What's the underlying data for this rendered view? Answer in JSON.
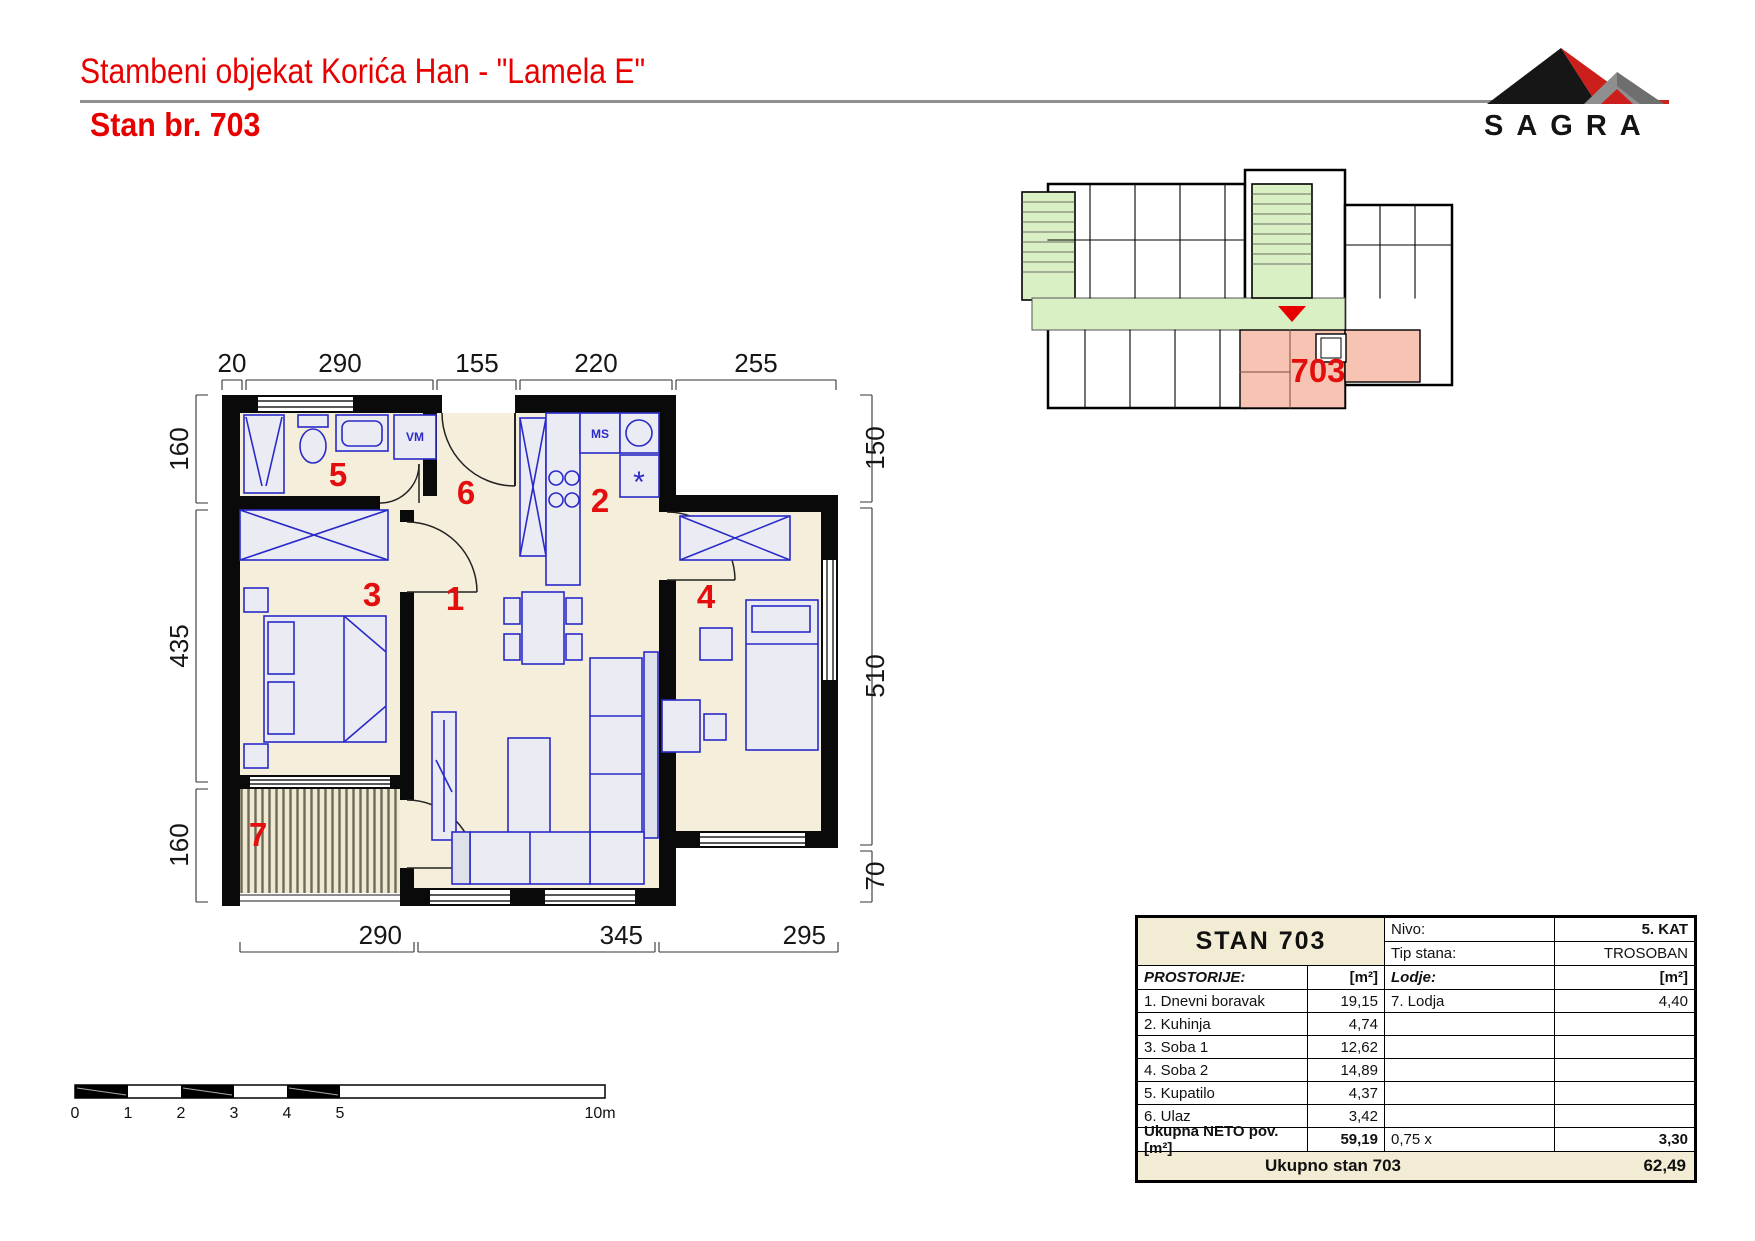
{
  "header": {
    "project_title": "Stambeni objekat Korića Han - \"Lamela E\"",
    "apartment_title": "Stan br. 703",
    "logo_text": "SAGRA"
  },
  "floor_plan": {
    "room_numbers": [
      "1",
      "2",
      "3",
      "4",
      "5",
      "6",
      "7"
    ],
    "fixture_labels": {
      "washing_machine": "VM",
      "kitchen_cabinet": "MS",
      "fridge": "*"
    },
    "dimensions": {
      "top": [
        "20",
        "290",
        "155",
        "220",
        "255"
      ],
      "left": [
        "160",
        "435",
        "160"
      ],
      "right": [
        "150",
        "510",
        "70"
      ],
      "bottom": [
        "290",
        "345",
        "295"
      ]
    }
  },
  "site_plan": {
    "unit_label": "703"
  },
  "scale_bar": {
    "labels": [
      "0",
      "1",
      "2",
      "3",
      "4",
      "5"
    ],
    "end_label": "10m"
  },
  "table": {
    "title": "STAN  703",
    "nivo_label": "Nivo:",
    "nivo_value": "5. KAT",
    "tip_label": "Tip stana:",
    "tip_value": "TROSOBAN",
    "rooms_header": "PROSTORIJE:",
    "rooms_unit": "[m²]",
    "lodje_header": "Lodje:",
    "lodje_unit": "[m²]",
    "rooms": [
      {
        "name": "1. Dnevni boravak",
        "area": "19,15"
      },
      {
        "name": "2. Kuhinja",
        "area": "4,74"
      },
      {
        "name": "3. Soba 1",
        "area": "12,62"
      },
      {
        "name": "4. Soba 2",
        "area": "14,89"
      },
      {
        "name": "5. Kupatilo",
        "area": "4,37"
      },
      {
        "name": "6. Ulaz",
        "area": "3,42"
      }
    ],
    "lodje": [
      {
        "name": "7. Lodja",
        "area": "4,40"
      }
    ],
    "neto_label": "Ukupna NETO pov. [m²]",
    "neto_value": "59,19",
    "factor_label": "0,75 x",
    "factor_value": "3,30",
    "total_label": "Ukupno stan 703",
    "total_value": "62,49"
  },
  "colors": {
    "accent_red": "#e80000",
    "floor_cream": "#f4eeda",
    "corridor_green": "#d9efc4",
    "unit_pink": "#f7c3b2",
    "furniture_blue": "#2a2ac9",
    "underline_gray": "#8f8f8f",
    "table_cream": "#f2ecd4"
  }
}
